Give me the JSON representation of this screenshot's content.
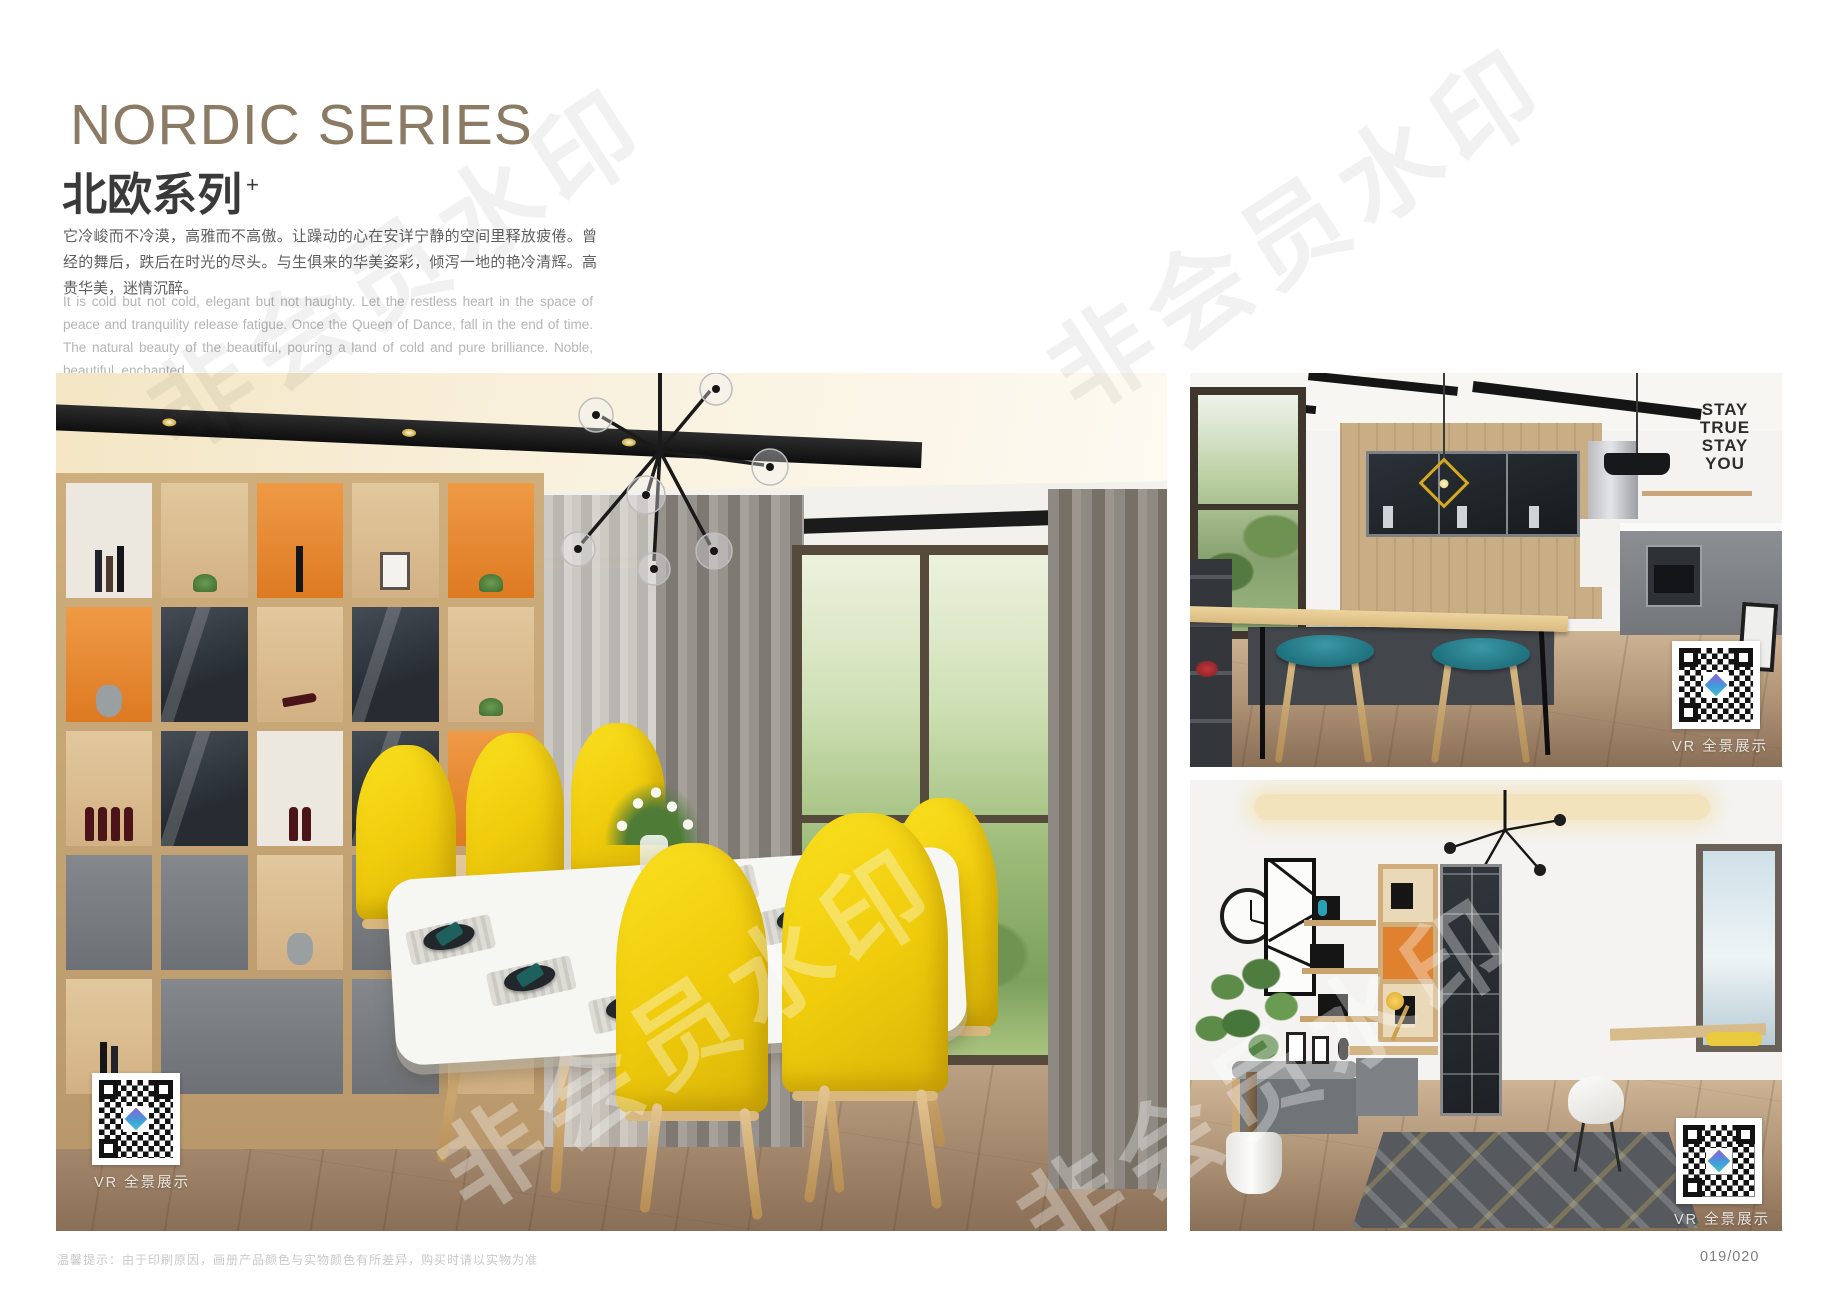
{
  "header": {
    "title_en": "NORDIC SERIES",
    "title_zh": "北欧系列",
    "title_superscript": "+",
    "paragraph_zh": "它冷峻而不冷漠，高雅而不高傲。让躁动的心在安详宁静的空间里释放疲倦。曾经的舞后，跌后在时光的尽头。与生俱来的华美姿彩，倾泻一地的艳冷清辉。高贵华美，迷情沉醉。",
    "paragraph_en": "It is cold but not cold, elegant but not haughty. Let the restless heart in the space of peace and tranquility release fatigue. Once the Queen of Dance, fall in the end of time. The natural beauty of the beautiful, pouring a land of cold and pure brilliance. Noble, beautiful, enchanted."
  },
  "colors": {
    "title_brown": "#8c7b64",
    "accent_orange": "#e0812f",
    "accent_yellow": "#f5d412",
    "accent_teal": "#2e7f8c"
  },
  "qr": {
    "label": "VR 全景展示"
  },
  "watermark": {
    "text": "非会员水印"
  },
  "photos": {
    "dining": {
      "alt": "北欧风餐厅：木色展示柜、黄色餐椅、白色餐桌"
    },
    "kitchen": {
      "alt": "开放式厨房：中岛吧台、青色吧凳、玻璃门吊柜",
      "wall_art": [
        "STAY",
        "TRUE",
        "STAY",
        "YOU"
      ]
    },
    "study": {
      "alt": "书房：书柜书桌、飘窗坐垫、绿植"
    }
  },
  "footer": {
    "disclaimer": "温馨提示：由于印刷原因，画册产品颜色与实物颜色有所差异，购买时请以实物为准",
    "page_number": "019/020"
  }
}
